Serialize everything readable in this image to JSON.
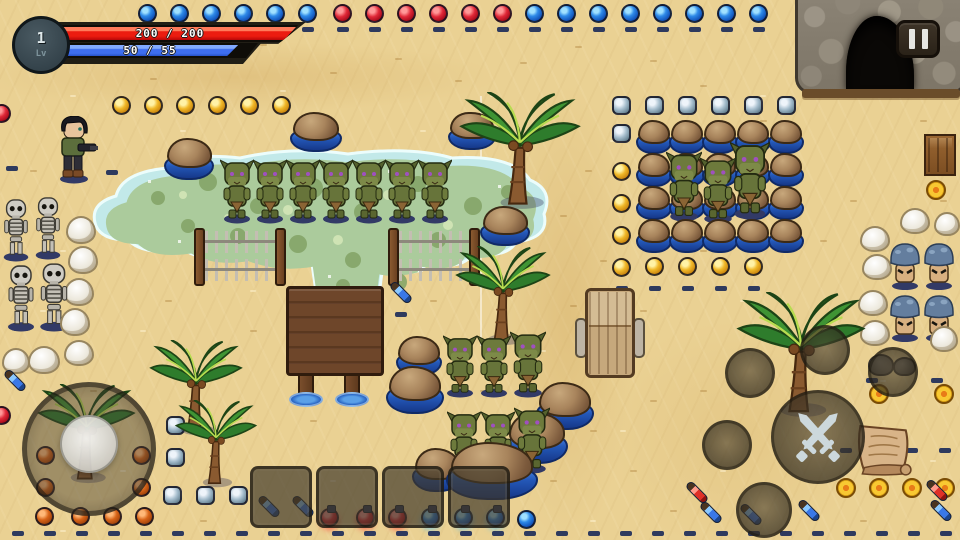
{
  "hud": {
    "level": "1",
    "level_label": "Lv",
    "hp_text": "200 / 200",
    "mp_text": "50 / 55",
    "hp_pct": 100,
    "mp_pct": 91
  },
  "pause_button": {
    "icon": "pause-icon"
  },
  "controls": {
    "attack_icon": "crossed-swords-icon",
    "empty_action_buttons": 5,
    "joystick": "movement-joystick"
  },
  "hotbar": {
    "slot_count": 4
  },
  "palette": {
    "sand": "#ead193",
    "pond_edge": "#c2e9e9",
    "pond_algae": "#abcb9c",
    "water_deep": "#2458b8",
    "hp_red": "#ec1c10",
    "mp_blue": "#3e6ef0",
    "ui_smoke": "rgba(48,42,30,0.72)"
  },
  "scene": {
    "sprites": [
      {
        "t": "pond",
        "x": 88,
        "y": 140,
        "w": 470,
        "h": 168
      },
      {
        "t": "cave",
        "x": 795,
        "y": -8,
        "w": 172,
        "h": 102
      },
      {
        "t": "palm",
        "x": 455,
        "y": 92,
        "w": 130,
        "h": 118
      },
      {
        "t": "palm",
        "x": 452,
        "y": 246,
        "w": 102,
        "h": 100
      },
      {
        "t": "palm",
        "x": 732,
        "y": 292,
        "w": 138,
        "h": 126
      },
      {
        "t": "palm",
        "x": 146,
        "y": 340,
        "w": 100,
        "h": 96
      },
      {
        "t": "palm",
        "x": 172,
        "y": 400,
        "w": 88,
        "h": 88
      },
      {
        "t": "palm",
        "x": 34,
        "y": 384,
        "w": 105,
        "h": 100
      },
      {
        "t": "rockwater",
        "x": 164,
        "y": 138,
        "w": 50,
        "h": 42
      },
      {
        "t": "rockwater",
        "x": 290,
        "y": 112,
        "w": 52,
        "h": 40
      },
      {
        "t": "rockwater",
        "x": 448,
        "y": 112,
        "w": 48,
        "h": 38
      },
      {
        "t": "rockwater",
        "x": 480,
        "y": 206,
        "w": 50,
        "h": 40
      },
      {
        "t": "rockwater_grid",
        "x": 636,
        "y": 120,
        "cols": 5,
        "rows": 4,
        "dx": 33,
        "dy": 33,
        "w": 36,
        "h": 34
      },
      {
        "t": "rockwater",
        "x": 396,
        "y": 336,
        "w": 46,
        "h": 40
      },
      {
        "t": "rockwater",
        "x": 386,
        "y": 366,
        "w": 58,
        "h": 48
      },
      {
        "t": "rockwater",
        "x": 536,
        "y": 382,
        "w": 58,
        "h": 48
      },
      {
        "t": "rockwater",
        "x": 506,
        "y": 412,
        "w": 62,
        "h": 52
      },
      {
        "t": "rockwater",
        "x": 412,
        "y": 448,
        "w": 50,
        "h": 44
      },
      {
        "t": "rockwater",
        "x": 446,
        "y": 442,
        "w": 92,
        "h": 58
      },
      {
        "t": "whiterock",
        "x": 66,
        "y": 216,
        "w": 30,
        "h": 28
      },
      {
        "t": "whiterock",
        "x": 68,
        "y": 246,
        "w": 30,
        "h": 28
      },
      {
        "t": "whiterock",
        "x": 64,
        "y": 278,
        "w": 30,
        "h": 28
      },
      {
        "t": "whiterock",
        "x": 60,
        "y": 308,
        "w": 30,
        "h": 28
      },
      {
        "t": "whiterock",
        "x": 28,
        "y": 346,
        "w": 32,
        "h": 28
      },
      {
        "t": "whiterock",
        "x": 64,
        "y": 340,
        "w": 30,
        "h": 26
      },
      {
        "t": "whiterock",
        "x": 2,
        "y": 348,
        "w": 28,
        "h": 26
      },
      {
        "t": "whiterock",
        "x": 860,
        "y": 226,
        "w": 30,
        "h": 26
      },
      {
        "t": "whiterock",
        "x": 862,
        "y": 254,
        "w": 30,
        "h": 26
      },
      {
        "t": "whiterock",
        "x": 858,
        "y": 290,
        "w": 30,
        "h": 26
      },
      {
        "t": "whiterock",
        "x": 860,
        "y": 320,
        "w": 30,
        "h": 26
      },
      {
        "t": "whiterock",
        "x": 930,
        "y": 326,
        "w": 28,
        "h": 26
      },
      {
        "t": "whiterock",
        "x": 900,
        "y": 208,
        "w": 30,
        "h": 26
      },
      {
        "t": "whiterock",
        "x": 934,
        "y": 212,
        "w": 26,
        "h": 24
      },
      {
        "t": "skeleton",
        "x": 0,
        "y": 198,
        "w": 32,
        "h": 64
      },
      {
        "t": "skeleton",
        "x": 32,
        "y": 196,
        "w": 32,
        "h": 64
      },
      {
        "t": "skeleton",
        "x": 4,
        "y": 264,
        "w": 34,
        "h": 68
      },
      {
        "t": "skeleton",
        "x": 36,
        "y": 262,
        "w": 36,
        "h": 70
      },
      {
        "t": "goblin",
        "x": 220,
        "y": 158,
        "w": 34,
        "h": 66
      },
      {
        "t": "goblin",
        "x": 253,
        "y": 158,
        "w": 34,
        "h": 66
      },
      {
        "t": "goblin",
        "x": 286,
        "y": 158,
        "w": 34,
        "h": 66
      },
      {
        "t": "goblin",
        "x": 319,
        "y": 158,
        "w": 34,
        "h": 66
      },
      {
        "t": "goblin",
        "x": 352,
        "y": 158,
        "w": 34,
        "h": 66
      },
      {
        "t": "goblin",
        "x": 385,
        "y": 158,
        "w": 34,
        "h": 66
      },
      {
        "t": "goblin",
        "x": 418,
        "y": 158,
        "w": 34,
        "h": 66
      },
      {
        "t": "goblin",
        "x": 666,
        "y": 150,
        "w": 36,
        "h": 72
      },
      {
        "t": "goblin",
        "x": 700,
        "y": 156,
        "w": 36,
        "h": 68
      },
      {
        "t": "goblin",
        "x": 730,
        "y": 140,
        "w": 40,
        "h": 80
      },
      {
        "t": "goblin",
        "x": 443,
        "y": 334,
        "w": 34,
        "h": 64
      },
      {
        "t": "goblin",
        "x": 477,
        "y": 334,
        "w": 34,
        "h": 64
      },
      {
        "t": "goblin",
        "x": 510,
        "y": 330,
        "w": 36,
        "h": 68
      },
      {
        "t": "goblin",
        "x": 447,
        "y": 410,
        "w": 34,
        "h": 64
      },
      {
        "t": "goblin",
        "x": 481,
        "y": 410,
        "w": 34,
        "h": 64
      },
      {
        "t": "goblin",
        "x": 514,
        "y": 406,
        "w": 36,
        "h": 68
      },
      {
        "t": "mushroom",
        "x": 888,
        "y": 238,
        "w": 34,
        "h": 52,
        "v": "capped"
      },
      {
        "t": "mushroom",
        "x": 922,
        "y": 238,
        "w": 34,
        "h": 52,
        "v": "capped"
      },
      {
        "t": "mushroom",
        "x": 888,
        "y": 290,
        "w": 34,
        "h": 52
      },
      {
        "t": "mushroom",
        "x": 922,
        "y": 290,
        "w": 34,
        "h": 52
      },
      {
        "t": "fence",
        "x": 194,
        "y": 228,
        "w": 92,
        "h": 58
      },
      {
        "t": "fence",
        "x": 388,
        "y": 228,
        "w": 92,
        "h": 58
      },
      {
        "t": "platform",
        "x": 286,
        "y": 286,
        "w": 98,
        "h": 124
      },
      {
        "t": "chair",
        "x": 575,
        "y": 288,
        "w": 70,
        "h": 92
      },
      {
        "t": "player",
        "x": 54,
        "y": 116,
        "w": 44,
        "h": 68
      },
      {
        "t": "scroll",
        "x": 850,
        "y": 422,
        "w": 64,
        "h": 56
      },
      {
        "t": "crate",
        "x": 924,
        "y": 134,
        "w": 32,
        "h": 42
      },
      {
        "t": "rockpair",
        "x": 866,
        "y": 352,
        "w": 52,
        "h": 26
      }
    ],
    "orb_rows": [
      {
        "c": "blue",
        "x": 138,
        "y": 4,
        "n": 6,
        "dx": 32
      },
      {
        "c": "red",
        "x": 333,
        "y": 4,
        "n": 6,
        "dx": 32
      },
      {
        "c": "blue",
        "x": 525,
        "y": 4,
        "n": 8,
        "dx": 32
      },
      {
        "c": "gold",
        "x": 112,
        "y": 96,
        "n": 6,
        "dx": 32
      },
      {
        "c": "silver",
        "x": 612,
        "y": 96,
        "n": 6,
        "dx": 33
      },
      {
        "c": "gold",
        "x": 645,
        "y": 257,
        "n": 4,
        "dx": 33
      }
    ],
    "orbs": [
      {
        "c": "silver",
        "x": 612,
        "y": 124
      },
      {
        "c": "gold",
        "x": 612,
        "y": 162
      },
      {
        "c": "gold",
        "x": 612,
        "y": 194
      },
      {
        "c": "gold",
        "x": 612,
        "y": 226
      },
      {
        "c": "gold",
        "x": 612,
        "y": 258
      },
      {
        "c": "silver",
        "x": 166,
        "y": 416
      },
      {
        "c": "silver",
        "x": 166,
        "y": 448
      },
      {
        "c": "silver",
        "x": 163,
        "y": 486
      },
      {
        "c": "silver",
        "x": 196,
        "y": 486
      },
      {
        "c": "silver",
        "x": 229,
        "y": 486
      },
      {
        "c": "orange",
        "x": 36,
        "y": 446
      },
      {
        "c": "orange",
        "x": 132,
        "y": 446
      },
      {
        "c": "orange",
        "x": 36,
        "y": 478
      },
      {
        "c": "orange",
        "x": 132,
        "y": 478
      },
      {
        "c": "orange",
        "x": 35,
        "y": 507
      },
      {
        "c": "orange",
        "x": 71,
        "y": 507
      },
      {
        "c": "orange",
        "x": 103,
        "y": 507
      },
      {
        "c": "orange",
        "x": 135,
        "y": 507
      },
      {
        "c": "red",
        "x": -8,
        "y": 104
      },
      {
        "c": "red",
        "x": -8,
        "y": 406
      },
      {
        "c": "red",
        "x": 320,
        "y": 508,
        "f": true
      },
      {
        "c": "red",
        "x": 356,
        "y": 508,
        "f": true
      },
      {
        "c": "red",
        "x": 388,
        "y": 508,
        "f": true
      },
      {
        "c": "blue",
        "x": 421,
        "y": 508,
        "f": true
      },
      {
        "c": "blue",
        "x": 454,
        "y": 508,
        "f": true
      },
      {
        "c": "blue",
        "x": 486,
        "y": 508,
        "f": true
      },
      {
        "c": "blue",
        "x": 517,
        "y": 510
      }
    ],
    "dash_rows": [
      {
        "x": 142,
        "y": 27,
        "n": 6,
        "dx": 32
      },
      {
        "x": 337,
        "y": 27,
        "n": 6,
        "dx": 32
      },
      {
        "x": 529,
        "y": 27,
        "n": 8,
        "dx": 32
      },
      {
        "x": 616,
        "y": 286,
        "n": 5,
        "dx": 33
      },
      {
        "x": 12,
        "y": 531,
        "n": 30,
        "dx": 32
      },
      {
        "x": 840,
        "y": 448,
        "n": 4,
        "dx": 33
      }
    ],
    "dashes": [
      [
        106,
        170
      ],
      [
        395,
        312
      ],
      [
        6,
        166
      ],
      [
        866,
        378
      ],
      [
        931,
        378
      ]
    ],
    "coins": [
      [
        869,
        384
      ],
      [
        934,
        384
      ],
      [
        836,
        478
      ],
      [
        869,
        478
      ],
      [
        902,
        478
      ],
      [
        935,
        478
      ],
      [
        926,
        180
      ]
    ],
    "vials": [
      {
        "c": "blue",
        "x": 2,
        "y": 376
      },
      {
        "c": "blue",
        "x": 388,
        "y": 288
      },
      {
        "c": "blue",
        "x": 256,
        "y": 502
      },
      {
        "c": "blue",
        "x": 290,
        "y": 502
      },
      {
        "c": "blue",
        "x": 698,
        "y": 508
      },
      {
        "c": "blue",
        "x": 738,
        "y": 510
      },
      {
        "c": "blue",
        "x": 796,
        "y": 506
      },
      {
        "c": "blue",
        "x": 928,
        "y": 506
      },
      {
        "c": "red",
        "x": 684,
        "y": 488
      },
      {
        "c": "red",
        "x": 924,
        "y": 486
      }
    ]
  }
}
